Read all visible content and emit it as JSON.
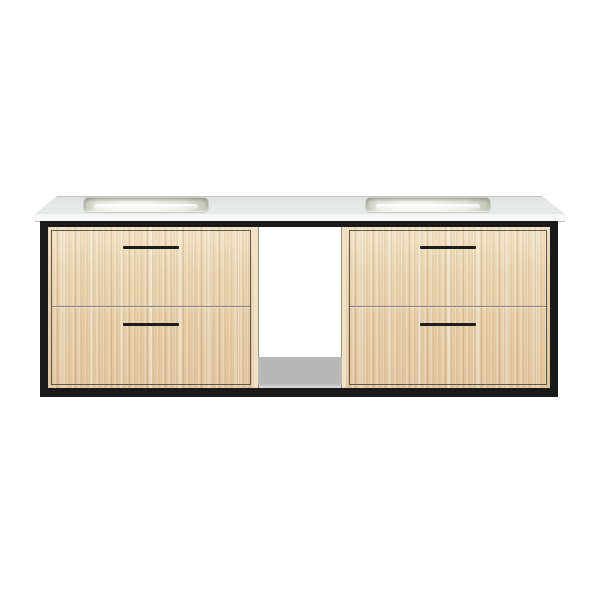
{
  "scene": {
    "type": "product-photo",
    "description": "Wall-mounted floating double-sink bathroom vanity: white stone countertop with two rectangular undermount basins, matte black metal frame, four light oak drawer fronts with slim black pulls, open white center cubby with gray shelf",
    "background_color": "#ffffff"
  },
  "colors": {
    "background": "#ffffff",
    "counter_top": "#e7e9e8",
    "counter_top_shade": "#dddfde",
    "counter_edge": "#f6f7f7",
    "counter_edge_line": "#c6c8c7",
    "frame_black": "#191919",
    "wood_base": "#e9d2ad",
    "wood_light": "#f2e1c2",
    "wood_dark": "#e0c49c",
    "drawer_outline": "#4d4338",
    "drawer_divider": "#8a7e6e",
    "handle_black": "#1d1d1d",
    "sink_basin_light": "#f4f5f0",
    "sink_basin_mid": "#e6e9df",
    "sink_basin_dark": "#c2c5b5",
    "cubby_white": "#ffffff",
    "shelf_gray": "#b7b7b7"
  },
  "parts": {
    "countertop": "white countertop",
    "left_sink": "left sink basin",
    "right_sink": "right sink basin",
    "frame": "black metal frame",
    "left_top_drawer": "left upper drawer",
    "left_bottom_drawer": "left lower drawer",
    "right_top_drawer": "right upper drawer",
    "right_bottom_drawer": "right lower drawer",
    "center_cubby": "open center shelf"
  }
}
